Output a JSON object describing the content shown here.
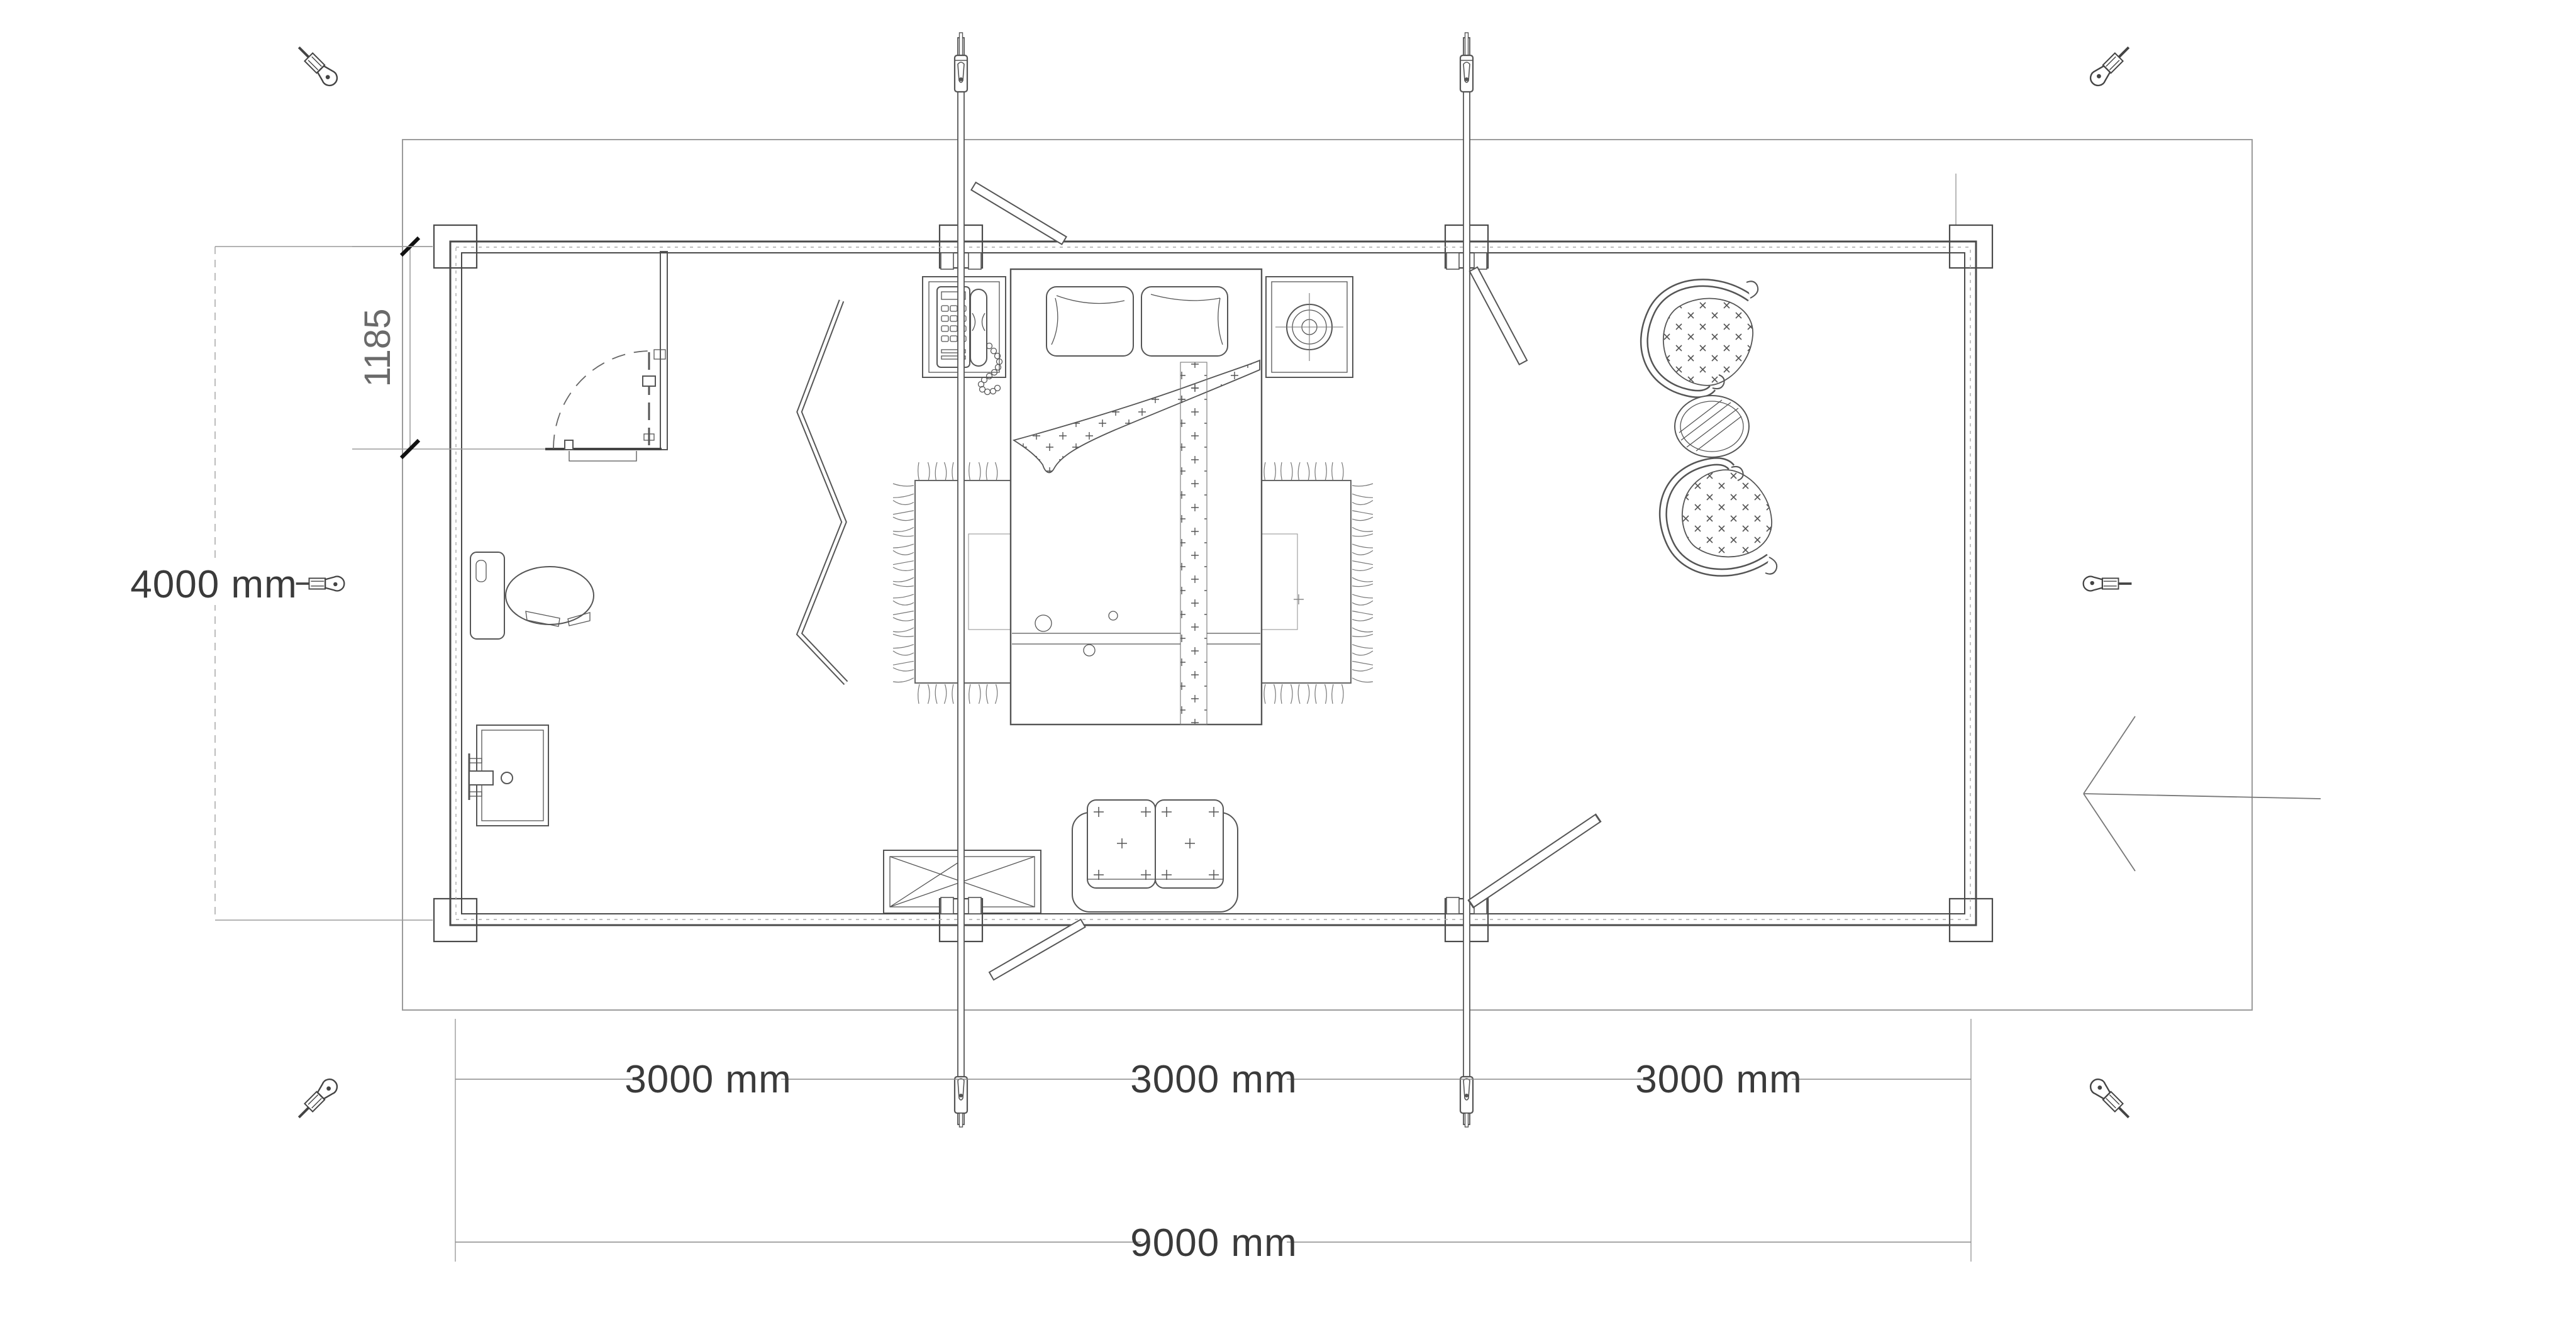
{
  "plan": {
    "title": "cabin-floor-plan",
    "dimensions": {
      "overall_width_label": "9000 mm",
      "overall_depth_label": "4000 mm",
      "bathroom_depth_label": "1185",
      "bays": [
        {
          "label": "3000 mm"
        },
        {
          "label": "3000 mm"
        },
        {
          "label": "3000 mm"
        }
      ]
    },
    "colors": {
      "ink": "#3a3a3a",
      "drawing_line": "#555555",
      "wall_line": "#4a4a4a",
      "aid_line": "#9b9b9b",
      "dimension_line": "#8a8a8a",
      "tick": "#111111",
      "background": "#ffffff"
    },
    "symbols": [
      "double-bed",
      "pillow",
      "duvet-fold",
      "area-rug",
      "telephone-nightstand",
      "lamp-nightstand",
      "folding-screen",
      "loveseat-sofa",
      "folding-table",
      "toilet",
      "washbasin",
      "bathroom-door",
      "lounge-chair",
      "round-table",
      "storm-brace-rod",
      "roof-brace-plank",
      "corner-post",
      "screw-fastener",
      "entrance-arrow",
      "site-boundary"
    ]
  }
}
